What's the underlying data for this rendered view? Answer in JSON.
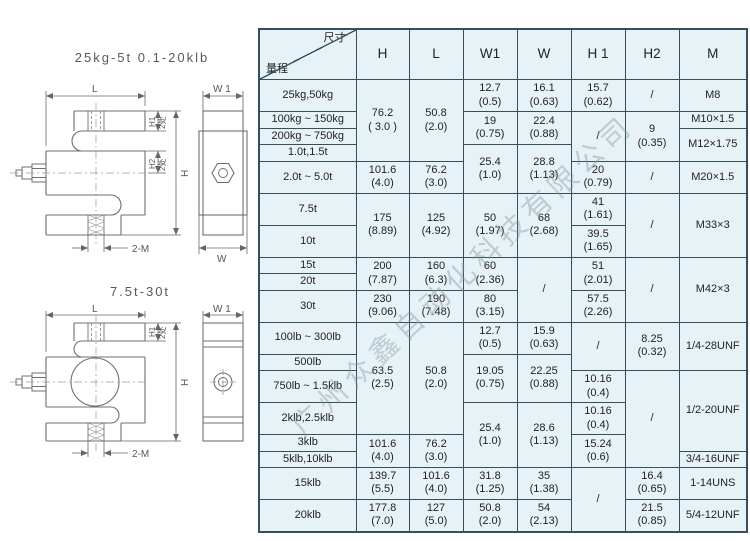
{
  "page": {
    "width": 750,
    "height": 541,
    "background": "#ffffff"
  },
  "watermark": {
    "text": "广州众鑫自动化科技有限公司"
  },
  "drawings": {
    "top": {
      "title": "25kg-5t 0.1-20klb",
      "labels": {
        "L": "L",
        "W1": "W 1",
        "H1": "H1",
        "H2": "H2",
        "H": "H",
        "W": "W",
        "M": "2-M",
        "places_h1": "2处",
        "places_h2": "2处"
      }
    },
    "bottom": {
      "title": "7.5t-30t",
      "labels": {
        "L": "L",
        "W1": "W 1",
        "H1": "H1",
        "H": "H",
        "M": "2-M",
        "places_h1": "2处"
      }
    }
  },
  "table": {
    "corner": {
      "top_right": "尺寸",
      "bottom_left": "量程"
    },
    "columns": [
      "H",
      "L",
      "W1",
      "W",
      "H 1",
      "H2",
      "M"
    ],
    "rows": [
      {
        "label": "25kg,50kg",
        "cells": [
          {
            "t": "76.2\n( 3.0 )",
            "rs": 4
          },
          {
            "t": "50.8\n(2.0)",
            "rs": 4
          },
          {
            "t": "12.7\n(0.5)"
          },
          {
            "t": "16.1\n(0.63)"
          },
          {
            "t": "15.7\n(0.62)"
          },
          {
            "t": "/"
          },
          {
            "t": "M8"
          }
        ]
      },
      {
        "label": "100kg ~ 150kg",
        "cells": [
          {
            "t": "19\n(0.75)",
            "rs": 2
          },
          {
            "t": "22.4\n(0.88)",
            "rs": 2
          },
          {
            "t": "/",
            "rs": 3
          },
          {
            "t": "9\n(0.35)",
            "rs": 3
          },
          {
            "t": "M10×1.5"
          }
        ]
      },
      {
        "label": "200kg ~ 750kg",
        "cells": [
          {
            "t": "M12×1.75",
            "rs": 2
          }
        ]
      },
      {
        "label": "1.0t,1.5t",
        "cells": [
          {
            "t": "25.4\n(1.0)",
            "rs": 2
          },
          {
            "t": "28.8\n(1.13)",
            "rs": 2
          }
        ]
      },
      {
        "label": "2.0t ~ 5.0t",
        "cells": [
          {
            "t": "101.6\n(4.0)"
          },
          {
            "t": "76.2\n(3.0)"
          },
          {
            "t": "20\n(0.79)"
          },
          {
            "t": "/"
          },
          {
            "t": "M20×1.5"
          }
        ]
      },
      {
        "label": "7.5t",
        "cells": [
          {
            "t": "175\n(8.89)",
            "rs": 2
          },
          {
            "t": "125\n(4.92)",
            "rs": 2
          },
          {
            "t": "50\n(1.97)",
            "rs": 2
          },
          {
            "t": "68\n(2.68)",
            "rs": 2
          },
          {
            "t": "41\n(1.61)"
          },
          {
            "t": "/",
            "rs": 2
          },
          {
            "t": "M33×3",
            "rs": 2
          }
        ]
      },
      {
        "label": "10t",
        "cells": [
          {
            "t": "39.5\n(1.65)"
          }
        ]
      },
      {
        "label": "15t",
        "cells": [
          {
            "t": "200\n(7.87)",
            "rs": 2
          },
          {
            "t": "160\n(6.3)",
            "rs": 2
          },
          {
            "t": "60\n(2.36)",
            "rs": 2
          },
          {
            "t": "/",
            "rs": 3
          },
          {
            "t": "51\n(2.01)",
            "rs": 2
          },
          {
            "t": "/",
            "rs": 3
          },
          {
            "t": "M42×3",
            "rs": 3
          }
        ]
      },
      {
        "label": "20t",
        "cells": []
      },
      {
        "label": "30t",
        "cells": [
          {
            "t": "230\n(9.06)"
          },
          {
            "t": "190\n(7.48)"
          },
          {
            "t": "80\n(3.15)"
          },
          {
            "t": "57.5\n(2.26)"
          }
        ]
      },
      {
        "label": "100lb ~ 300lb",
        "cells": [
          {
            "t": "63.5\n(2.5)",
            "rs": 4
          },
          {
            "t": "50.8\n(2.0)",
            "rs": 4
          },
          {
            "t": "12.7\n(0.5)"
          },
          {
            "t": "15.9\n(0.63)"
          },
          {
            "t": "/",
            "rs": 2
          },
          {
            "t": "8.25\n(0.32)",
            "rs": 2
          },
          {
            "t": "1/4-28UNF",
            "rs": 2
          }
        ]
      },
      {
        "label": "500lb",
        "cells": [
          {
            "t": "19.05\n(0.75)",
            "rs": 2
          },
          {
            "t": "22.25\n(0.88)",
            "rs": 2
          }
        ]
      },
      {
        "label": "750lb ~ 1.5klb",
        "cells": [
          {
            "t": "10.16\n(0.4)"
          },
          {
            "t": "/",
            "rs": 4
          },
          {
            "t": "1/2-20UNF",
            "rs": 3
          }
        ]
      },
      {
        "label": "2klb,2.5klb",
        "cells": [
          {
            "t": "25.4\n(1.0)",
            "rs": 3
          },
          {
            "t": "28.6\n(1.13)",
            "rs": 3
          },
          {
            "t": "10.16\n(0.4)"
          }
        ]
      },
      {
        "label": "3klb",
        "cells": [
          {
            "t": "101.6\n(4.0)",
            "rs": 2
          },
          {
            "t": "76.2\n(3.0)",
            "rs": 2
          },
          {
            "t": "15.24\n(0.6)",
            "rs": 2
          }
        ]
      },
      {
        "label": "5klb,10klb",
        "cells": [
          {
            "t": "3/4-16UNF"
          }
        ]
      },
      {
        "label": "15klb",
        "cells": [
          {
            "t": "139.7\n(5.5)"
          },
          {
            "t": "101.6\n(4.0)"
          },
          {
            "t": "31.8\n(1.25)"
          },
          {
            "t": "35\n(1.38)"
          },
          {
            "t": "/",
            "rs": 2
          },
          {
            "t": "16.4\n(0.65)"
          },
          {
            "t": "1-14UNS"
          }
        ]
      },
      {
        "label": "20klb",
        "cells": [
          {
            "t": "177.8\n(7.0)"
          },
          {
            "t": "127\n(5.0)"
          },
          {
            "t": "50.8\n(2.0)"
          },
          {
            "t": "54\n(2.13)"
          },
          {
            "t": "21.5\n(0.85)"
          },
          {
            "t": "5/4-12UNF"
          }
        ]
      }
    ]
  },
  "colors": {
    "table_bg": "#e7f2f7",
    "table_border": "#35505c",
    "drawing_line": "#6f6f6f",
    "text": "#222222"
  }
}
